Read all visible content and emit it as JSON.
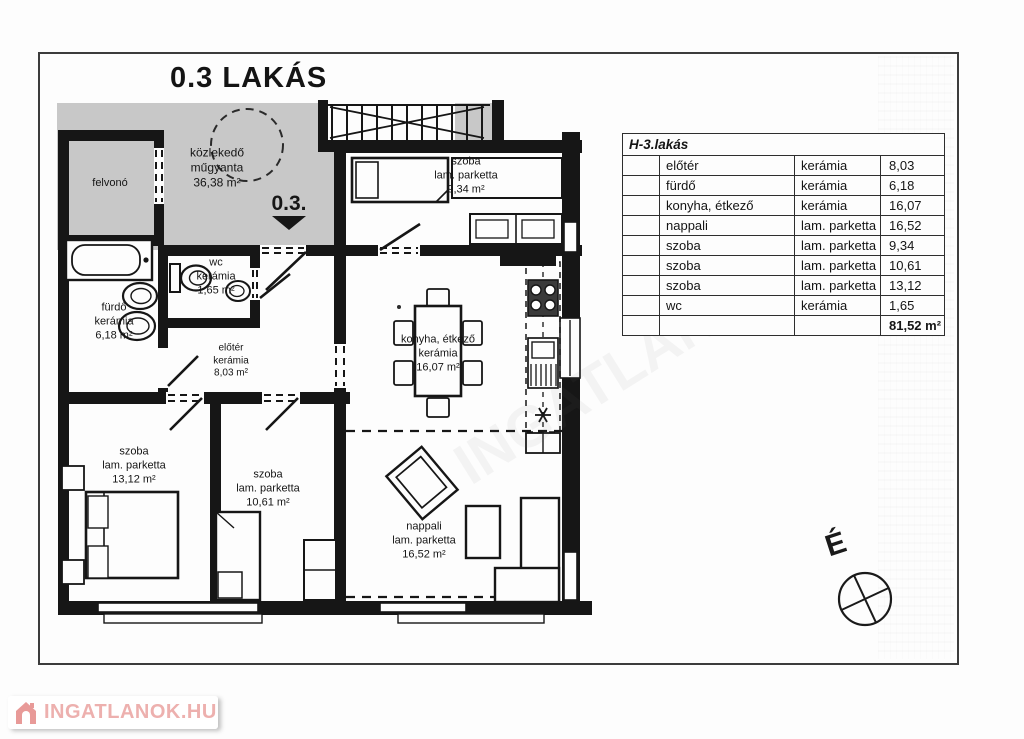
{
  "title": "0.3 LAKÁS",
  "unit_marker": {
    "label": "0.3."
  },
  "compass": {
    "label": "É"
  },
  "watermark": {
    "label": "INGATLANOK.HU"
  },
  "plan": {
    "rooms": {
      "felvono": {
        "name": "felvonó"
      },
      "kozlekedo": {
        "name": "közlekedő",
        "material": "műgyanta",
        "area": "36,38 m²"
      },
      "szoba_934": {
        "name": "szoba",
        "material": "lam. parketta",
        "area": "9,34 m²"
      },
      "wc": {
        "name": "wc",
        "material": "kerámia",
        "area": "1,65 m²"
      },
      "furdo": {
        "name": "fürdő",
        "material": "kerámia",
        "area": "6,18 m²"
      },
      "eloter": {
        "name": "előtér",
        "material": "kerámia",
        "area": "8,03 m²"
      },
      "konyha": {
        "name": "konyha, étkező",
        "material": "kerámia",
        "area": "16,07 m²"
      },
      "szoba_1312": {
        "name": "szoba",
        "material": "lam. parketta",
        "area": "13,12 m²"
      },
      "szoba_1061": {
        "name": "szoba",
        "material": "lam. parketta",
        "area": "10,61 m²"
      },
      "nappali": {
        "name": "nappali",
        "material": "lam. parketta",
        "area": "16,52 m²"
      }
    }
  },
  "table": {
    "title": "H-3.lakás",
    "rows": [
      {
        "room": "előtér",
        "material": "kerámia",
        "area": "8,03"
      },
      {
        "room": "fürdő",
        "material": "kerámia",
        "area": "6,18"
      },
      {
        "room": "konyha, étkező",
        "material": "kerámia",
        "area": "16,07"
      },
      {
        "room": "nappali",
        "material": "lam. parketta",
        "area": "16,52"
      },
      {
        "room": "szoba",
        "material": "lam. parketta",
        "area": "9,34"
      },
      {
        "room": "szoba",
        "material": "lam. parketta",
        "area": "10,61"
      },
      {
        "room": "szoba",
        "material": "lam. parketta",
        "area": "13,12"
      },
      {
        "room": "wc",
        "material": "kerámia",
        "area": "1,65"
      }
    ],
    "total": "81,52 m²"
  },
  "colors": {
    "wall": "#161616",
    "common_area": "#c8c8c8",
    "watermark_red": "#edb0ae"
  }
}
